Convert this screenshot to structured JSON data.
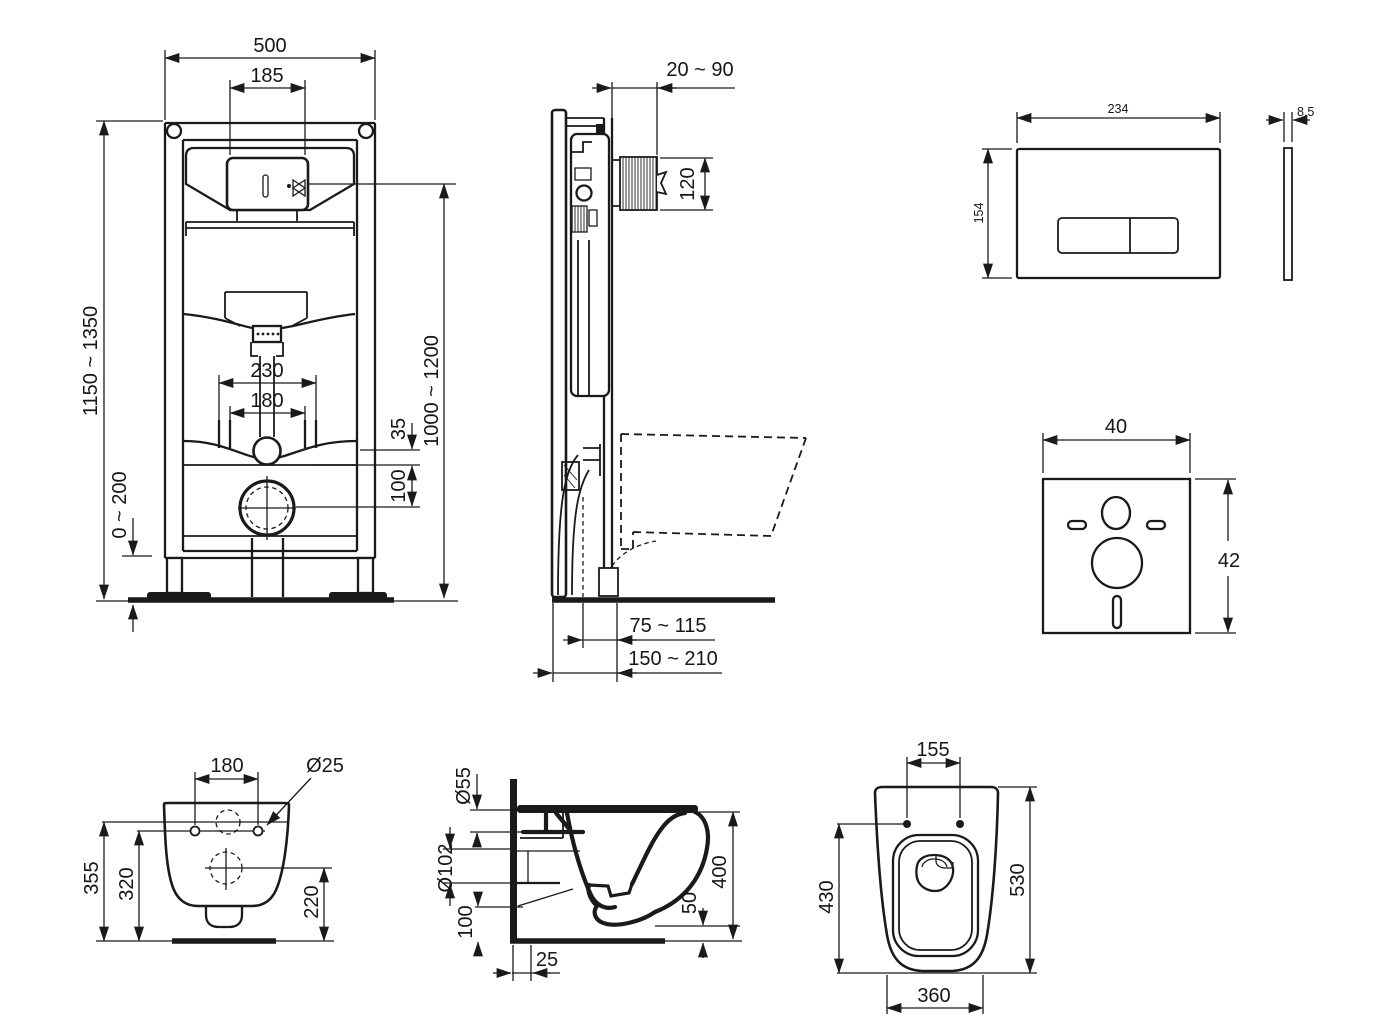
{
  "page": {
    "background": "#ffffff",
    "ink": "#1a1a1a",
    "description": "Wall-hung WC installation frame dimensional drawing"
  },
  "views": {
    "frame_front": {
      "label": "frame front view",
      "dims": {
        "overall_width": "500",
        "opening_width": "185",
        "frame_height": "1150 ~ 1350",
        "outer_fixing_spacing": "230",
        "fixing_spacing": "180",
        "flush_offset": "35",
        "fixing_to_drain": "100",
        "foot_adjustment": "0 ~ 200",
        "inlet_height": "1000 ~ 1200"
      }
    },
    "frame_side": {
      "label": "frame side view",
      "dims": {
        "wall_offset": "20 ~ 90",
        "duct_height": "120",
        "drain_offset_near": "75 ~ 115",
        "drain_offset_far": "150 ~ 210"
      }
    },
    "flush_plate": {
      "label": "flush plate",
      "dims": {
        "width": "234",
        "height": "154",
        "thickness": "8,5"
      }
    },
    "sound_pad": {
      "label": "sound insulation pad",
      "dims": {
        "width": "40",
        "height": "42"
      }
    },
    "bowl_back": {
      "label": "bowl rear view",
      "dims": {
        "fixing_spacing": "180",
        "hole_diameter": "Ø25",
        "height_overall": "355",
        "height_fixings": "320",
        "height_drain": "220"
      }
    },
    "bowl_side": {
      "label": "bowl side view",
      "dims": {
        "inlet_diameter": "Ø55",
        "outlet_diameter": "Ø102",
        "outlet_height": "100",
        "wall_gap": "25",
        "rim_clearance": "50",
        "depth": "400"
      }
    },
    "bowl_top": {
      "label": "bowl top view",
      "dims": {
        "fixing_spacing": "155",
        "bowl_length": "430",
        "overall_length": "530",
        "width": "360"
      }
    }
  }
}
